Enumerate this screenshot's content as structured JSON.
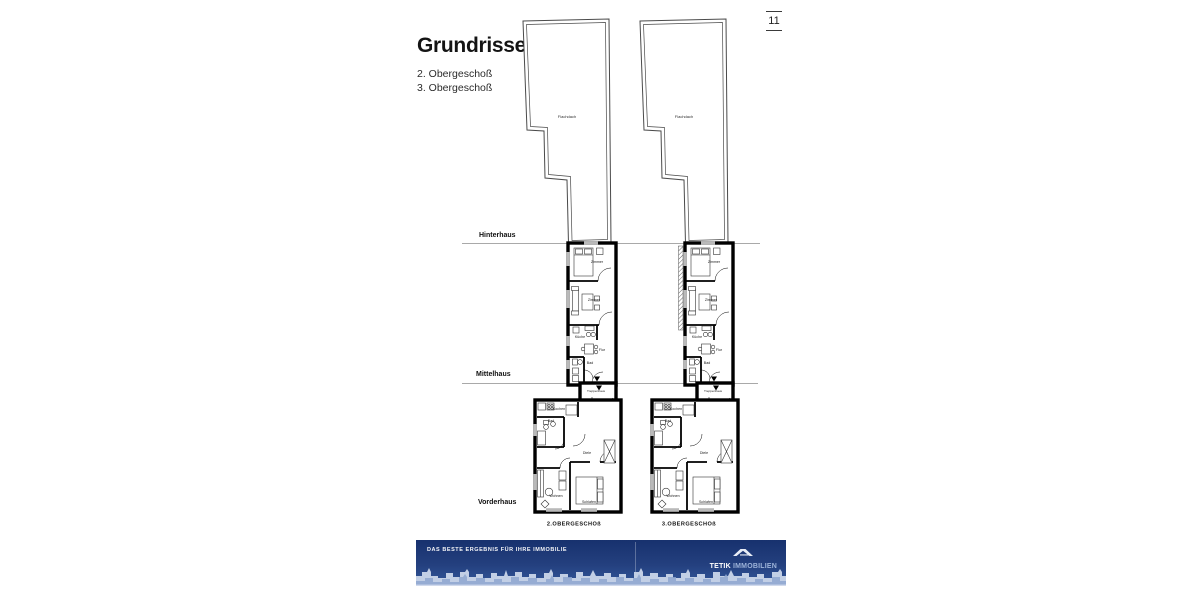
{
  "page": {
    "number": "11",
    "background": "#ffffff"
  },
  "header": {
    "title": "Grundrisse",
    "subtitle_lines": [
      "2. Obergeschoß",
      "3. Obergeschoß"
    ]
  },
  "sections": {
    "hinterhaus": "Hinterhaus",
    "mittelhaus": "Mittelhaus",
    "vorderhaus": "Vorderhaus"
  },
  "plans": [
    {
      "caption": "2.OBERGESCHOß",
      "rooms": {
        "flachdach": "Flachdach",
        "zimmer_a": "Zimmer",
        "zimmer_b": "Zimmer",
        "kueche": "Küche",
        "flur": "Flur",
        "bad_og": "Bad",
        "treppenhaus": "Treppenhaus",
        "kochen": "Kochen",
        "bad_vh": "Bad",
        "diele": "Diele",
        "wohnen": "Wohnen",
        "schlafen": "Schlafen"
      }
    },
    {
      "caption": "3.OBERGESCHOß",
      "rooms": {
        "flachdach": "Flachdach",
        "zimmer_a": "Zimmer",
        "zimmer_b": "Zimmer",
        "kueche": "Küche",
        "flur": "Flur",
        "bad_og": "Bad",
        "treppenhaus": "Treppenhaus",
        "kochen": "Kochen",
        "bad_vh": "Bad",
        "diele": "Diele",
        "wohnen": "Wohnen",
        "schlafen": "Schlafen"
      }
    }
  ],
  "footer": {
    "tagline": "DAS BESTE ERGEBNIS FÜR IHRE IMMOBILIE",
    "brand": {
      "primary": "TETIK",
      "secondary": "IMMOBILIEN"
    },
    "colors": {
      "banner_top": "#17316e",
      "banner_bottom": "#33589c",
      "skyline_light": "#cfdaed",
      "skyline_dark": "#8ea6cf"
    }
  }
}
